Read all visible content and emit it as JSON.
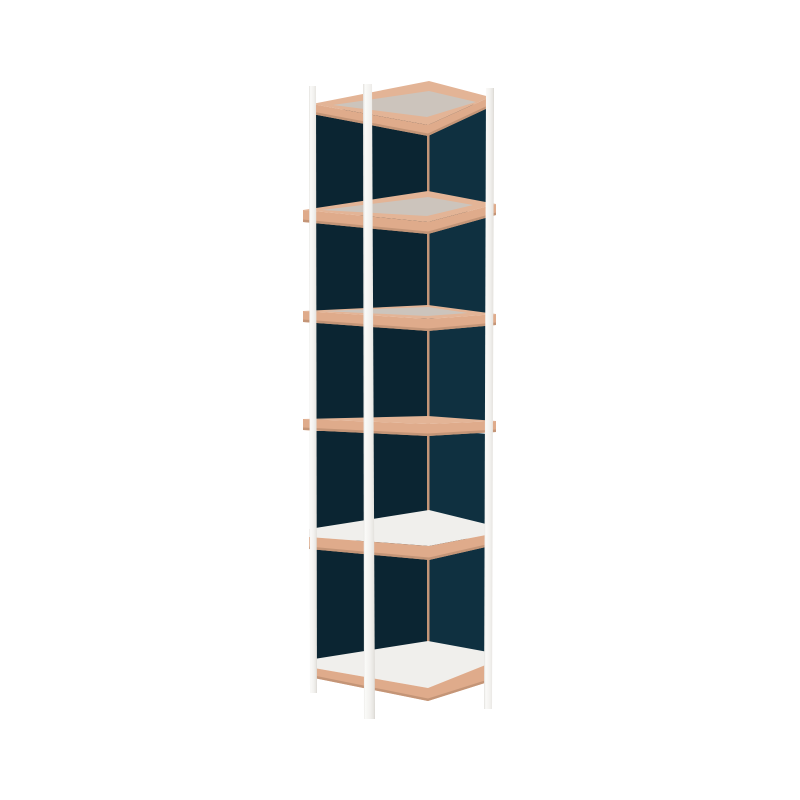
{
  "meta": {
    "subject": "shelf-unit-product-render",
    "background": "#ffffff"
  },
  "palette": {
    "background": "#ffffff",
    "woodTop": "#e3b496",
    "woodFascia": "#dfab8b",
    "woodDark": "#c49577",
    "greyTop": "#ccc4bc",
    "whiteTop": "#f0efec",
    "panelLeft": "#0b2532",
    "panelRight": "#0f3040",
    "post_gradient": [
      [
        0,
        "#e2e0dc"
      ],
      [
        0.18,
        "#fafaf8"
      ],
      [
        0.6,
        "#f2f1ee"
      ],
      [
        0.88,
        "#e7e5e1"
      ],
      [
        1,
        "#d8d5d0"
      ]
    ]
  },
  "scene": {
    "viewbox": [
      0,
      0,
      800,
      800
    ],
    "layers": [
      {
        "name": "back-corner-seam",
        "fill": "woodDark",
        "points": [
          [
            426.5,
            94
          ],
          [
            430,
            94
          ],
          [
            430,
            650
          ],
          [
            426.5,
            650
          ]
        ]
      },
      {
        "name": "bay1-left-panel",
        "fill": "panelLeft",
        "points": [
          [
            315.5,
            115
          ],
          [
            427,
            94
          ],
          [
            427,
            192
          ],
          [
            315.5,
            211
          ]
        ]
      },
      {
        "name": "bay1-right-panel",
        "fill": "panelRight",
        "points": [
          [
            429.5,
            94
          ],
          [
            488,
            108
          ],
          [
            488,
            205
          ],
          [
            429.5,
            192
          ]
        ]
      },
      {
        "name": "bay2-left-panel",
        "fill": "panelLeft",
        "points": [
          [
            315.5,
            223
          ],
          [
            427,
            204
          ],
          [
            427,
            306
          ],
          [
            315.5,
            312
          ]
        ]
      },
      {
        "name": "bay2-right-panel",
        "fill": "panelRight",
        "points": [
          [
            429.5,
            204
          ],
          [
            488,
            216
          ],
          [
            488,
            315
          ],
          [
            429.5,
            306
          ]
        ]
      },
      {
        "name": "bay3-left-panel",
        "fill": "panelLeft",
        "points": [
          [
            315.5,
            323
          ],
          [
            427,
            318
          ],
          [
            427,
            417
          ],
          [
            315.5,
            420
          ]
        ]
      },
      {
        "name": "bay3-right-panel",
        "fill": "panelRight",
        "points": [
          [
            429.5,
            318
          ],
          [
            488,
            326
          ],
          [
            488,
            422
          ],
          [
            429.5,
            417
          ]
        ]
      },
      {
        "name": "bay4-left-panel",
        "fill": "panelLeft",
        "points": [
          [
            315.5,
            431
          ],
          [
            427,
            429
          ],
          [
            427,
            511
          ],
          [
            315.5,
            530
          ]
        ]
      },
      {
        "name": "bay4-right-panel",
        "fill": "panelRight",
        "points": [
          [
            429.5,
            429
          ],
          [
            488,
            434
          ],
          [
            488,
            525
          ],
          [
            429.5,
            511
          ]
        ]
      },
      {
        "name": "bay5-left-panel",
        "fill": "panelLeft",
        "points": [
          [
            315.5,
            550
          ],
          [
            427,
            523
          ],
          [
            427,
            642
          ],
          [
            315.5,
            660
          ]
        ]
      },
      {
        "name": "bay5-right-panel",
        "fill": "panelRight",
        "points": [
          [
            429.5,
            523
          ],
          [
            488,
            548
          ],
          [
            488,
            653
          ],
          [
            429.5,
            642
          ]
        ]
      },
      {
        "name": "shelf1-rim-top",
        "fill": "woodTop",
        "points": [
          [
            312,
            104
          ],
          [
            429,
            81
          ],
          [
            490,
            97
          ],
          [
            428,
            125
          ]
        ]
      },
      {
        "name": "shelf1-surface",
        "fill": "greyTop",
        "points": [
          [
            333,
            105
          ],
          [
            429,
            91
          ],
          [
            476,
            102
          ],
          [
            427,
            117
          ]
        ]
      },
      {
        "name": "shelf1-fascia",
        "fill": "woodFascia",
        "points": [
          [
            312,
            104
          ],
          [
            428,
            125
          ],
          [
            490,
            97
          ],
          [
            490,
            107
          ],
          [
            428,
            136
          ],
          [
            312,
            114
          ]
        ]
      },
      {
        "name": "shelf1-fascia-edge",
        "fill": "woodDark",
        "points": [
          [
            312,
            111.5
          ],
          [
            428,
            133.5
          ],
          [
            490,
            104.5
          ],
          [
            490,
            107
          ],
          [
            428,
            136
          ],
          [
            312,
            114
          ]
        ]
      },
      {
        "name": "shelf2-rim-top",
        "fill": "woodTop",
        "points": [
          [
            303,
            210
          ],
          [
            428,
            191
          ],
          [
            496,
            204
          ],
          [
            428,
            222
          ]
        ]
      },
      {
        "name": "shelf2-surface",
        "fill": "greyTop",
        "points": [
          [
            322,
            210
          ],
          [
            428,
            197
          ],
          [
            473,
            205
          ],
          [
            427,
            216
          ]
        ]
      },
      {
        "name": "shelf2-fascia",
        "fill": "woodFascia",
        "points": [
          [
            303,
            210
          ],
          [
            428,
            222
          ],
          [
            496,
            204
          ],
          [
            496,
            215
          ],
          [
            428,
            234
          ],
          [
            303,
            222
          ]
        ]
      },
      {
        "name": "shelf2-fascia-edge",
        "fill": "woodDark",
        "points": [
          [
            303,
            219.5
          ],
          [
            428,
            231.5
          ],
          [
            496,
            212.5
          ],
          [
            496,
            215
          ],
          [
            428,
            234
          ],
          [
            303,
            222
          ]
        ]
      },
      {
        "name": "shelf3-rim-top",
        "fill": "woodTop",
        "points": [
          [
            303,
            311
          ],
          [
            428,
            305
          ],
          [
            496,
            314
          ],
          [
            428,
            319
          ]
        ]
      },
      {
        "name": "shelf3-surface",
        "fill": "greyTop",
        "points": [
          [
            322,
            311
          ],
          [
            428,
            307
          ],
          [
            468,
            313
          ],
          [
            427,
            316
          ]
        ]
      },
      {
        "name": "shelf3-fascia",
        "fill": "woodFascia",
        "points": [
          [
            303,
            311
          ],
          [
            428,
            319
          ],
          [
            496,
            314
          ],
          [
            496,
            325
          ],
          [
            428,
            331
          ],
          [
            303,
            322
          ]
        ]
      },
      {
        "name": "shelf3-fascia-edge",
        "fill": "woodDark",
        "points": [
          [
            303,
            319.5
          ],
          [
            428,
            328.5
          ],
          [
            496,
            322.5
          ],
          [
            496,
            325
          ],
          [
            428,
            331
          ],
          [
            303,
            322
          ]
        ]
      },
      {
        "name": "shelf4-rim-top",
        "fill": "woodTop",
        "points": [
          [
            303,
            419
          ],
          [
            428,
            416
          ],
          [
            496,
            421
          ],
          [
            428,
            424
          ]
        ]
      },
      {
        "name": "shelf4-fascia",
        "fill": "woodFascia",
        "points": [
          [
            303,
            419
          ],
          [
            428,
            424
          ],
          [
            496,
            421
          ],
          [
            496,
            432
          ],
          [
            428,
            436
          ],
          [
            303,
            430
          ]
        ]
      },
      {
        "name": "shelf4-fascia-edge",
        "fill": "woodDark",
        "points": [
          [
            303,
            427.5
          ],
          [
            428,
            433.5
          ],
          [
            496,
            429.5
          ],
          [
            496,
            432
          ],
          [
            428,
            436
          ],
          [
            303,
            430
          ]
        ]
      },
      {
        "name": "shelf5-surface",
        "fill": "whiteTop",
        "points": [
          [
            309,
            529
          ],
          [
            429,
            510
          ],
          [
            486,
            524
          ],
          [
            486,
            535
          ],
          [
            429,
            546
          ],
          [
            309,
            537
          ]
        ]
      },
      {
        "name": "shelf5-fascia",
        "fill": "woodFascia",
        "points": [
          [
            309,
            537
          ],
          [
            429,
            546
          ],
          [
            486,
            535
          ],
          [
            486,
            547
          ],
          [
            429,
            560
          ],
          [
            309,
            549
          ]
        ]
      },
      {
        "name": "shelf5-fascia-edge",
        "fill": "woodDark",
        "points": [
          [
            309,
            546.5
          ],
          [
            429,
            557.5
          ],
          [
            486,
            544.5
          ],
          [
            486,
            547
          ],
          [
            429,
            560
          ],
          [
            309,
            549
          ]
        ]
      },
      {
        "name": "shelf6-surface",
        "fill": "whiteTop",
        "points": [
          [
            314,
            659
          ],
          [
            428,
            641
          ],
          [
            488,
            652
          ],
          [
            488,
            664
          ],
          [
            428,
            688
          ],
          [
            314,
            668
          ]
        ]
      },
      {
        "name": "shelf6-fascia",
        "fill": "woodFascia",
        "points": [
          [
            314,
            668
          ],
          [
            428,
            688
          ],
          [
            488,
            664
          ],
          [
            488,
            682
          ],
          [
            428,
            701
          ],
          [
            314,
            678
          ]
        ]
      },
      {
        "name": "shelf6-fascia-edge",
        "fill": "woodDark",
        "points": [
          [
            314,
            675.5
          ],
          [
            428,
            698.5
          ],
          [
            488,
            679.5
          ],
          [
            488,
            682
          ],
          [
            428,
            701
          ],
          [
            314,
            678
          ]
        ]
      },
      {
        "name": "post-left",
        "fill": "post-grad",
        "points": [
          [
            309,
            86
          ],
          [
            316,
            86
          ],
          [
            317,
            693
          ],
          [
            310,
            693
          ]
        ]
      },
      {
        "name": "post-front",
        "fill": "post-grad",
        "points": [
          [
            363,
            84
          ],
          [
            372,
            84
          ],
          [
            375,
            719
          ],
          [
            364,
            719
          ]
        ]
      },
      {
        "name": "post-right",
        "fill": "post-grad",
        "points": [
          [
            486,
            88
          ],
          [
            494,
            88
          ],
          [
            492,
            709
          ],
          [
            484,
            709
          ]
        ]
      }
    ]
  }
}
